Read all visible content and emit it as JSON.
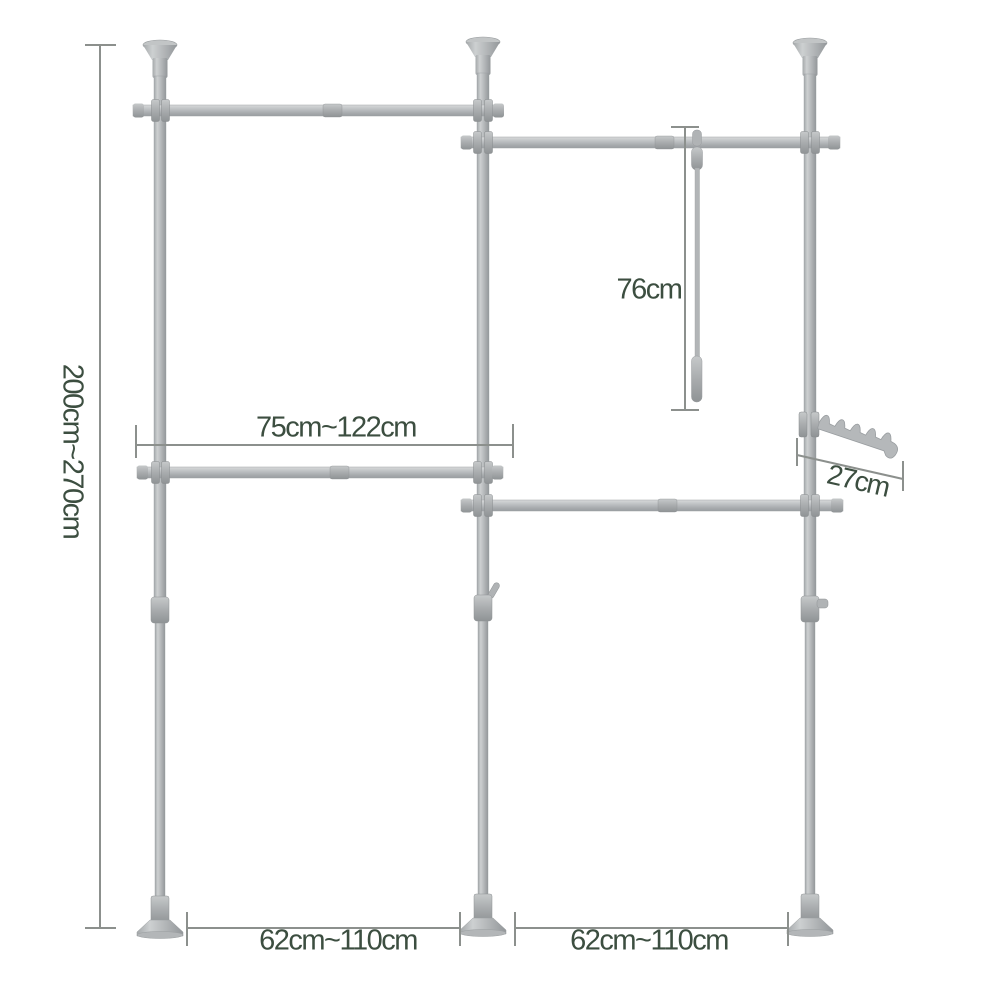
{
  "dimensions": {
    "height_range": "200cm~270cm",
    "upper_rail_range": "75cm~122cm",
    "strap_length": "76cm",
    "hook_arm_length": "27cm",
    "left_bay_range": "62cm~110cm",
    "right_bay_range": "62cm~110cm"
  },
  "colors": {
    "background": "#ffffff",
    "label_text": "#3c4e40",
    "dimension_line": "#8c908d",
    "rack_light": "#d8dadb",
    "rack_mid": "#b6b9bb",
    "rack_dark": "#989c9e"
  }
}
